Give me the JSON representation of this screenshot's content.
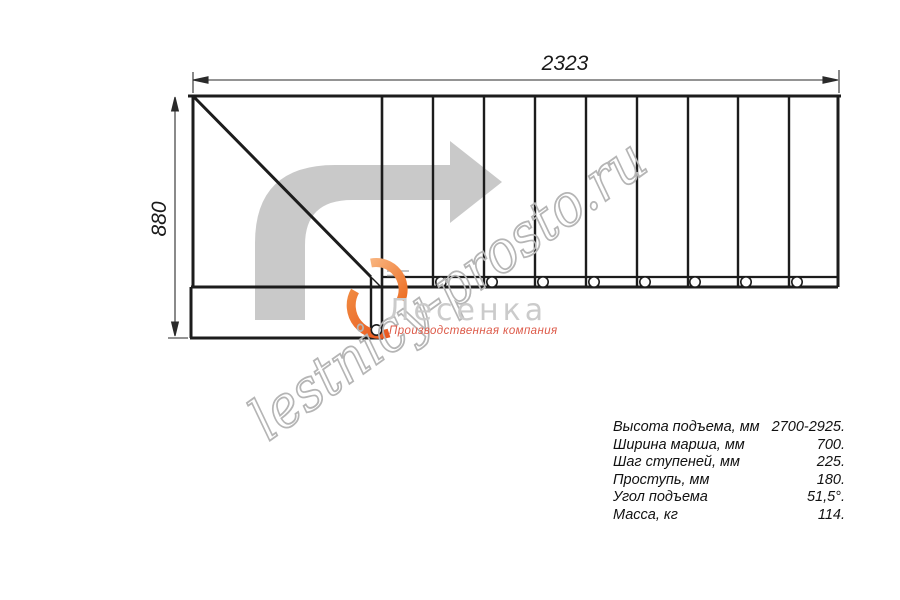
{
  "dimensions": {
    "width_mm": "2323",
    "height_mm": "880"
  },
  "watermark": {
    "text": "lestnicy-prosto.ru",
    "color": "#b5b5b5"
  },
  "logo": {
    "name": "Лесенка",
    "tagline": "Производственная компания",
    "name_color": "#cbcbcb",
    "tagline_color": "#dd5a49",
    "flame_colors": [
      "#f8b27c",
      "#e9581f"
    ]
  },
  "drawing": {
    "type": "staircase-plan-top-view",
    "steps_count": 9,
    "baluster_count": 9,
    "line_color": "#1c1c1c",
    "arrow_color": "#c9c9c9"
  },
  "specs": {
    "rows": [
      {
        "label": "Высота подъема, мм",
        "value": "2700-2925."
      },
      {
        "label": "Ширина марша, мм",
        "value": "700."
      },
      {
        "label": "Шаг ступеней, мм",
        "value": "225."
      },
      {
        "label": "Проступь, мм",
        "value": "180."
      },
      {
        "label": "Угол подъема",
        "value": "51,5°."
      },
      {
        "label": "Масса, кг",
        "value": "114."
      }
    ]
  }
}
